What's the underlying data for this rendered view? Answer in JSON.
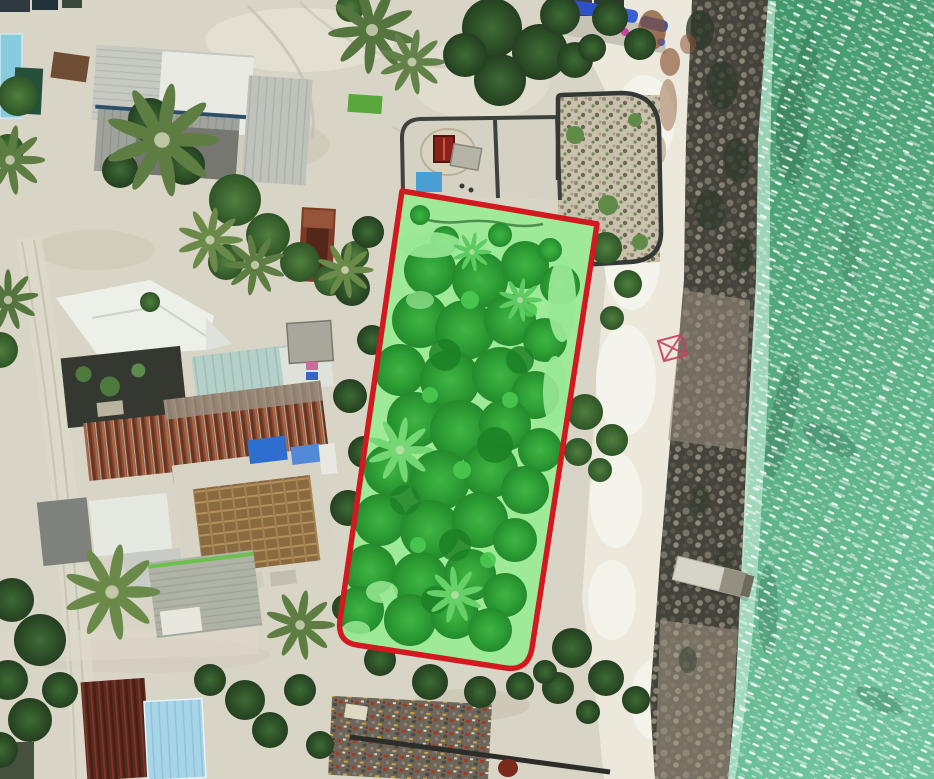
{
  "scene": {
    "type": "aerial-orthophoto",
    "subject": "coastal-village-with-highlighted-land-plot",
    "annotation": {
      "boundary_color": "#d2191f",
      "boundary_stroke_width": "5.5",
      "fill_tint": "#44d649",
      "fill_tint_opacity": "0.18",
      "marker": "x-survey-marker",
      "marker_color": "#c84060"
    },
    "colors": {
      "sand": "#d9d5c6",
      "beach": "#ece9dc",
      "water_deep": "#3f9468",
      "water_light": "#6fc29b",
      "water_shallow_edge": "#b7e3cb",
      "rock_dark": "#45443c",
      "rock_light": "#9a9080",
      "vegetation_dark": "#2a4f26",
      "plot_canopy": "#2a9232",
      "plot_ground": "#b4eeab"
    },
    "features": [
      "village-buildings",
      "walled-compound",
      "highlighted-plot",
      "breakwater-rocks",
      "beach",
      "ocean",
      "jetty",
      "debris-pile",
      "palm-trees"
    ]
  }
}
